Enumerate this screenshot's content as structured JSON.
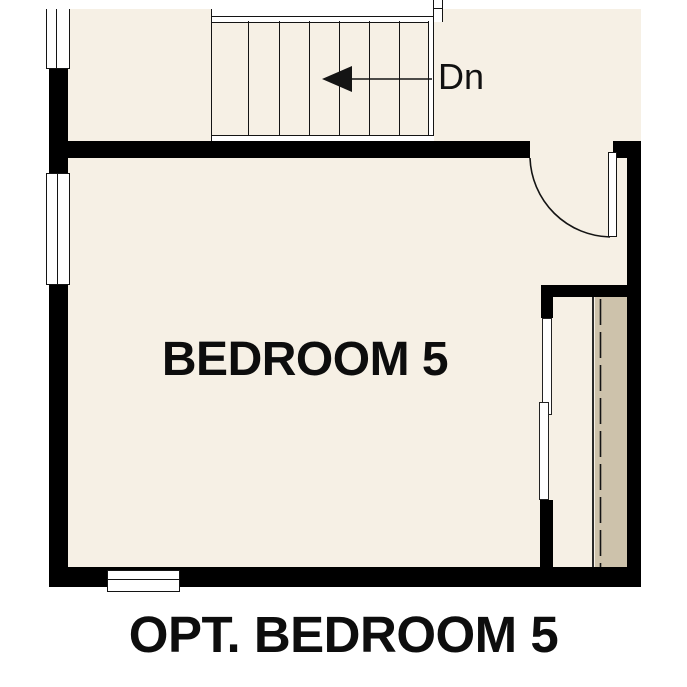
{
  "labels": {
    "room": "BEDROOM 5",
    "caption": "OPT. BEDROOM 5",
    "stair_direction": "Dn"
  },
  "icons": {
    "stair_direction_arrow": "left-arrow"
  },
  "stairs": {
    "tread_count": 7
  },
  "colors": {
    "background": "#ffffff",
    "floor": "#f6f0e5",
    "closet_shelf": "#cdc2ab",
    "wall": "#000000",
    "line": "#141414"
  }
}
